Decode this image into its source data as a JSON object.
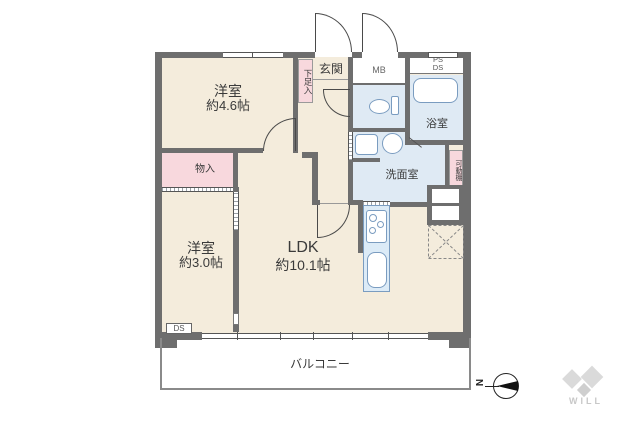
{
  "rooms": {
    "bedroom_1": {
      "label": "洋室",
      "size": "約4.6帖"
    },
    "bedroom_2": {
      "label": "洋室",
      "size": "約3.0帖"
    },
    "ldk": {
      "label": "LDK",
      "size": "約10.1帖"
    },
    "entrance": {
      "label": "玄関"
    },
    "bathroom": {
      "label": "浴室"
    },
    "washroom": {
      "label": "洗面室"
    },
    "balcony": {
      "label": "バルコニー"
    }
  },
  "features": {
    "shoe_cabinet": {
      "label": "下足入"
    },
    "storage": {
      "label": "物入"
    },
    "movable_shelf": {
      "label": "可動棚"
    },
    "meter_box": {
      "label": "MB"
    },
    "pipe_space": {
      "label": "PS"
    },
    "duct_space_top": {
      "label": "DS"
    },
    "duct_space_bottom": {
      "label": "DS"
    }
  },
  "compass": {
    "north_label": "N"
  },
  "branding": {
    "logo_text": "WILL"
  },
  "colors": {
    "wall": "#6e6e6e",
    "floor": "#f4ecdc",
    "wet_area": "#dfeaf4",
    "closet": "#f8d8dd",
    "counter": "#dcebf7",
    "fixture_stroke": "#7a9cc0",
    "line": "#555555"
  }
}
